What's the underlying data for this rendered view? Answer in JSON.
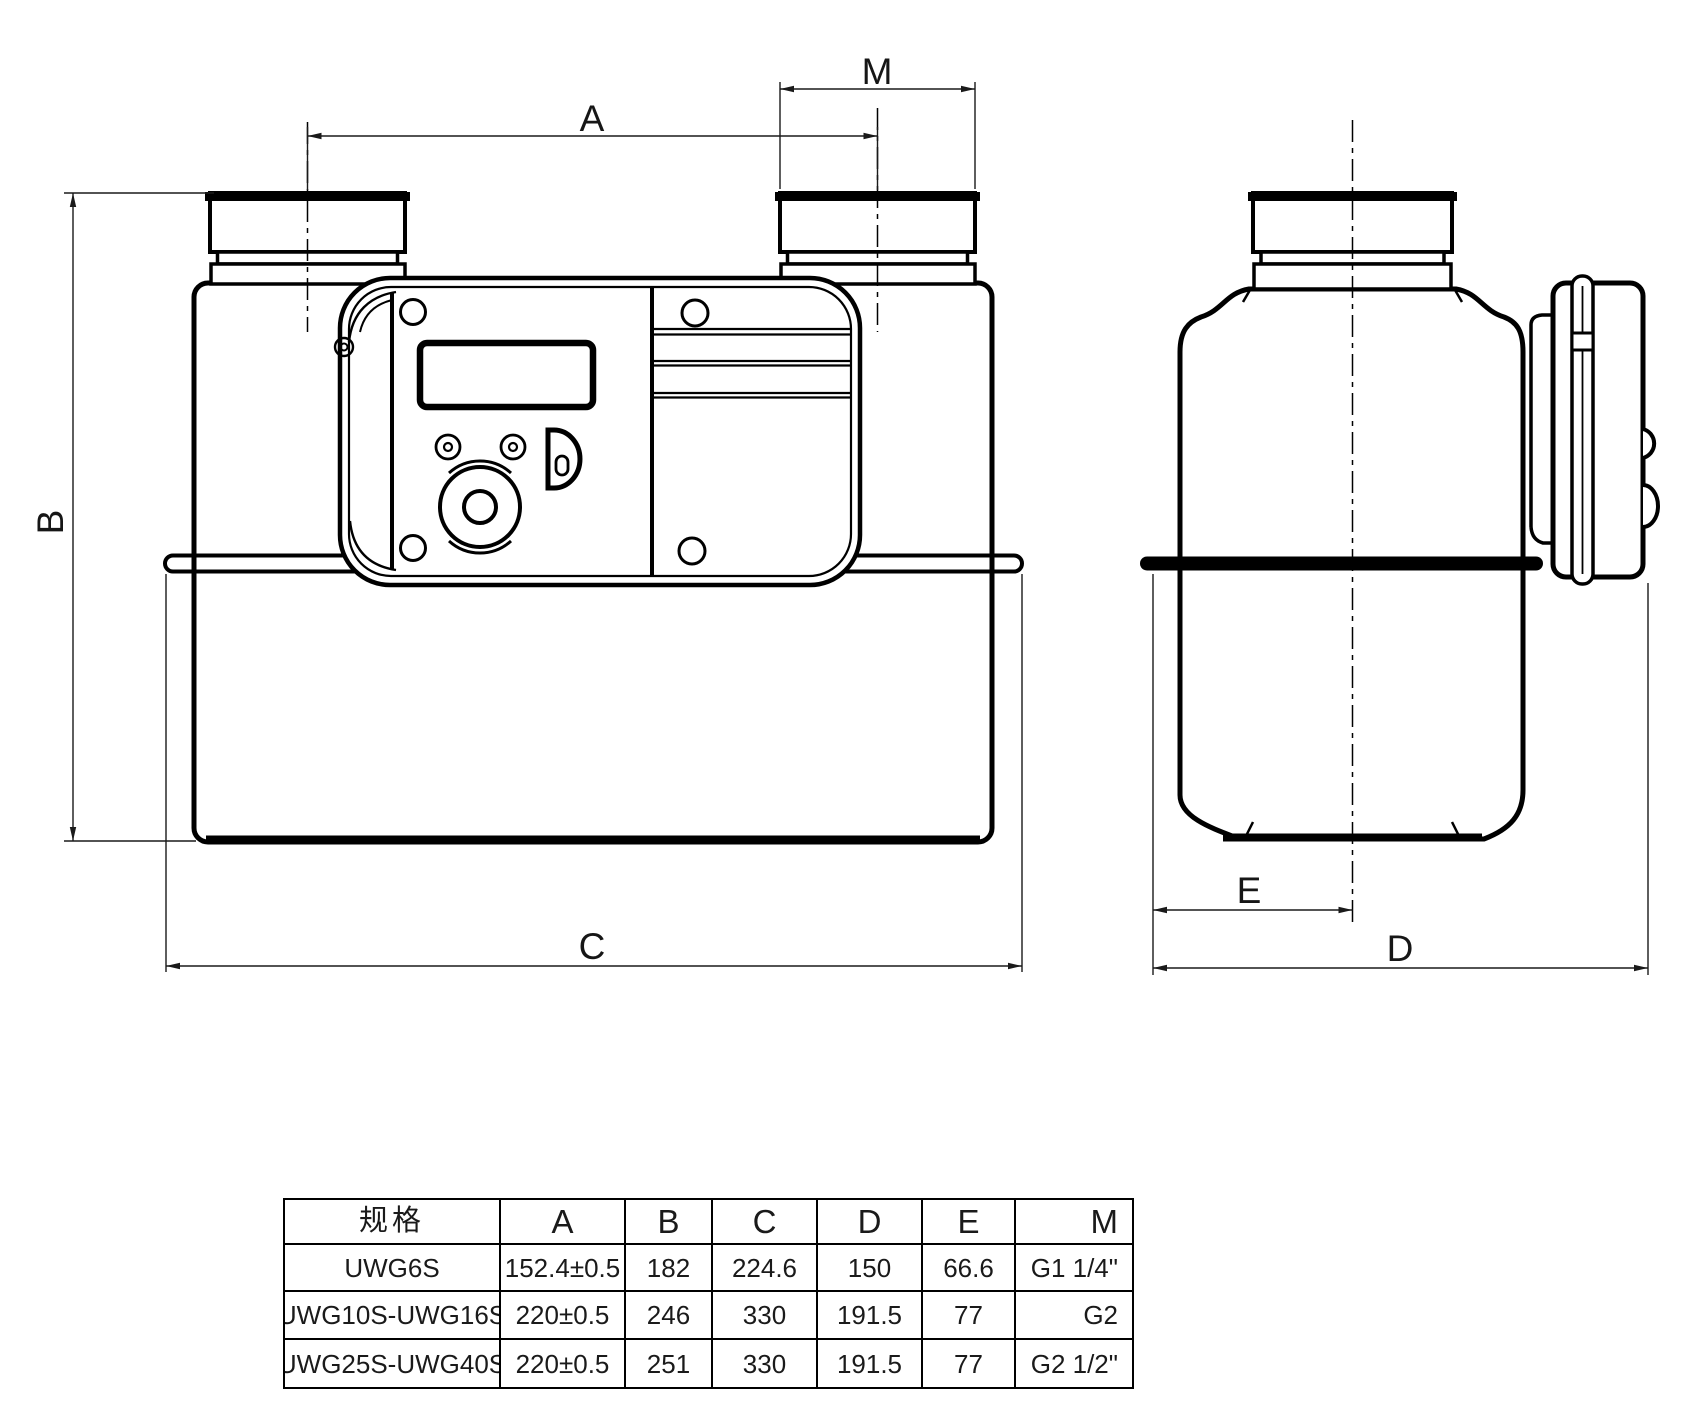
{
  "drawing": {
    "dimension_labels": {
      "A": "A",
      "B": "B",
      "C": "C",
      "D": "D",
      "E": "E",
      "M": "M"
    }
  },
  "table": {
    "headers": [
      "规格",
      "A",
      "B",
      "C",
      "D",
      "E",
      "M"
    ],
    "rows": [
      [
        "UWG6S",
        "152.4±0.5",
        "182",
        "224.6",
        "150",
        "66.6",
        "G1 1/4\""
      ],
      [
        "UWG10S-UWG16S",
        "220±0.5",
        "246",
        "330",
        "191.5",
        "77",
        "G2"
      ],
      [
        "UWG25S-UWG40S",
        "220±0.5",
        "251",
        "330",
        "191.5",
        "77",
        "G2 1/2\""
      ]
    ]
  },
  "colors": {
    "line": "#000000",
    "dim_line": "#1a1a1a",
    "background": "#ffffff"
  }
}
